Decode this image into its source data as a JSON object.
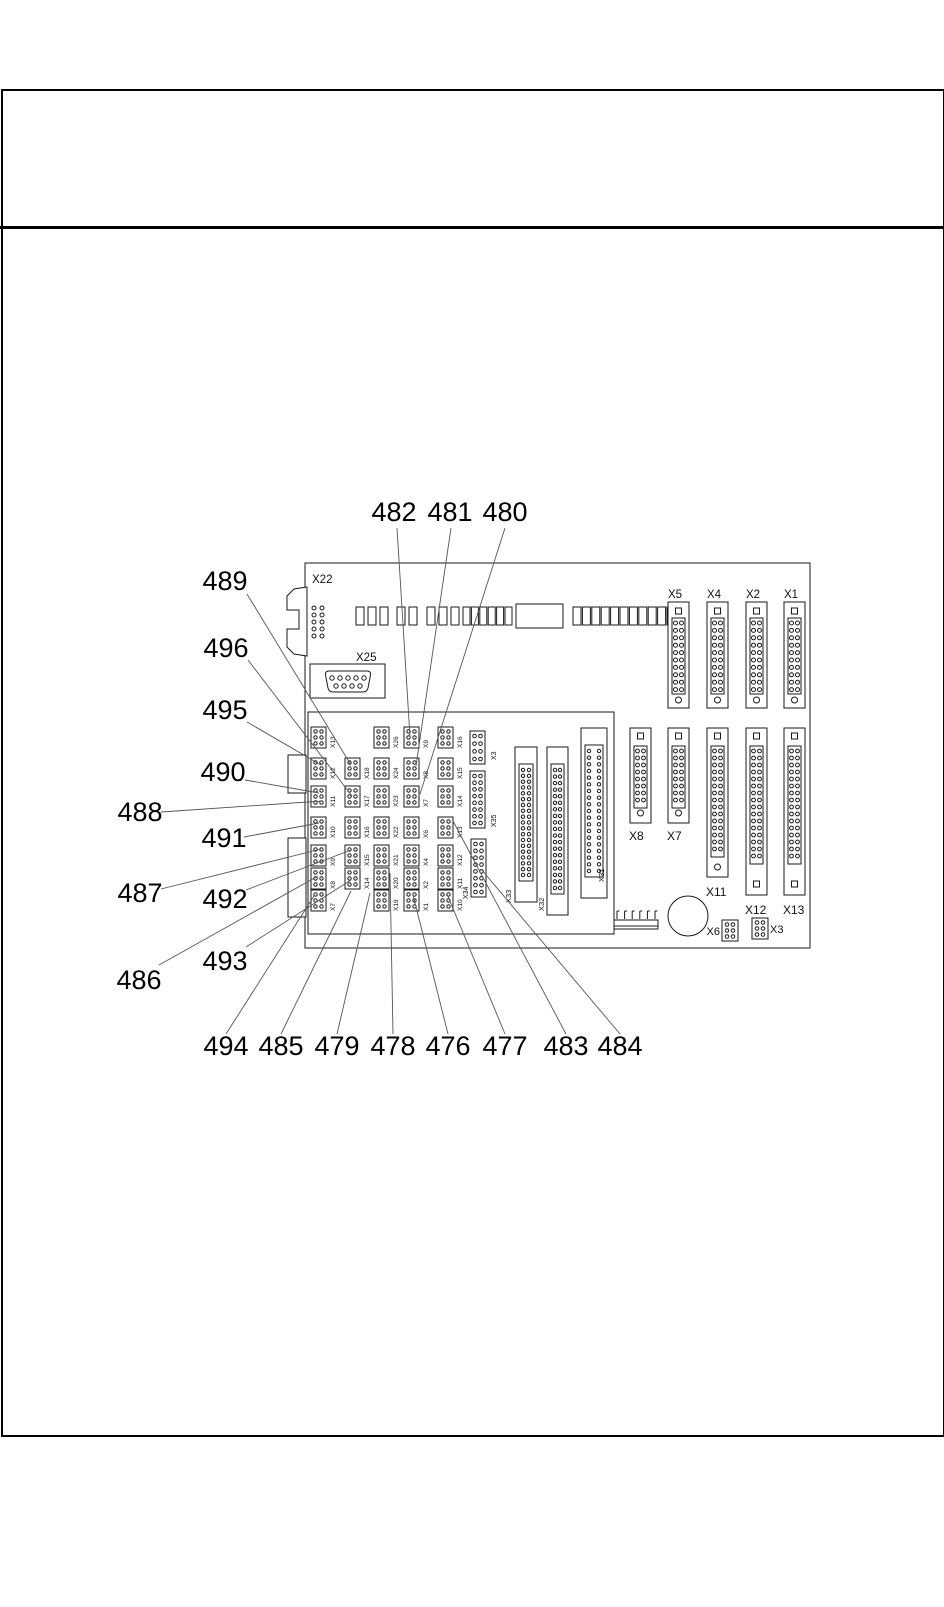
{
  "page": {
    "kind": "service-manual connector location diagram",
    "background": "#ffffff",
    "line_color": "#1a1a1a",
    "leader_color": "#555555"
  },
  "callouts": {
    "top": [
      {
        "label": "482",
        "x": 394,
        "y": 521,
        "line": [
          397,
          528,
          410,
          737
        ]
      },
      {
        "label": "481",
        "x": 450,
        "y": 521,
        "line": [
          451,
          528,
          416,
          766
        ]
      },
      {
        "label": "480",
        "x": 505,
        "y": 521,
        "line": [
          505,
          528,
          420,
          794
        ]
      }
    ],
    "left": [
      {
        "label": "489",
        "x": 225,
        "y": 590,
        "line": [
          247,
          594,
          351,
          765
        ]
      },
      {
        "label": "496",
        "x": 226,
        "y": 657,
        "line": [
          248,
          660,
          352,
          796
        ]
      },
      {
        "label": "495",
        "x": 225,
        "y": 719,
        "line": [
          247,
          722,
          321,
          765
        ]
      },
      {
        "label": "490",
        "x": 223,
        "y": 781,
        "line": [
          245,
          780,
          319,
          793
        ]
      },
      {
        "label": "488",
        "x": 140,
        "y": 821,
        "line": [
          161,
          812,
          322,
          801
        ]
      },
      {
        "label": "491",
        "x": 224,
        "y": 847,
        "line": [
          244,
          837,
          319,
          823
        ]
      },
      {
        "label": "487",
        "x": 140,
        "y": 902,
        "line": [
          161,
          889,
          321,
          849
        ]
      },
      {
        "label": "492",
        "x": 225,
        "y": 908,
        "line": [
          246,
          890,
          351,
          850
        ]
      },
      {
        "label": "486",
        "x": 139,
        "y": 989,
        "line": [
          159,
          965,
          318,
          876
        ]
      },
      {
        "label": "493",
        "x": 225,
        "y": 970,
        "line": [
          246,
          947,
          351,
          880
        ]
      }
    ],
    "bottom": [
      {
        "label": "494",
        "x": 226,
        "y": 1055,
        "line": [
          226,
          1034,
          314,
          896
        ]
      },
      {
        "label": "485",
        "x": 281,
        "y": 1055,
        "line": [
          281,
          1034,
          351,
          891
        ]
      },
      {
        "label": "479",
        "x": 337,
        "y": 1055,
        "line": [
          337,
          1034,
          370,
          893
        ]
      },
      {
        "label": "478",
        "x": 393,
        "y": 1055,
        "line": [
          393,
          1034,
          390,
          873
        ]
      },
      {
        "label": "476",
        "x": 448,
        "y": 1055,
        "line": [
          448,
          1034,
          413,
          895
        ]
      },
      {
        "label": "477",
        "x": 505,
        "y": 1055,
        "line": [
          505,
          1034,
          447,
          894
        ]
      },
      {
        "label": "483",
        "x": 566,
        "y": 1055,
        "line": [
          566,
          1034,
          453,
          821
        ]
      },
      {
        "label": "484",
        "x": 620,
        "y": 1055,
        "line": [
          620,
          1034,
          481,
          869
        ]
      }
    ]
  },
  "board": {
    "bracket_connector": {
      "label": "X22"
    },
    "serial_connector": {
      "label": "X25"
    },
    "top_right_connectors": [
      {
        "label": "X5",
        "x": 668
      },
      {
        "label": "X4",
        "x": 707
      },
      {
        "label": "X2",
        "x": 746
      },
      {
        "label": "X1",
        "x": 784
      }
    ],
    "right_connectors": [
      {
        "label": "X8",
        "x": 630,
        "h": 95,
        "rows": 8,
        "label_y": 840,
        "bottom": "circle"
      },
      {
        "label": "X7",
        "x": 668,
        "h": 95,
        "rows": 8,
        "label_y": 840,
        "bottom": "circle"
      },
      {
        "label": "X11",
        "x": 707,
        "h": 149,
        "rows": 15,
        "label_y": 896,
        "bottom": "circle"
      },
      {
        "label": "X12",
        "x": 746,
        "h": 167,
        "rows": 16,
        "label_y": 914,
        "bottom": "square"
      },
      {
        "label": "X13",
        "x": 784,
        "h": 167,
        "rows": 16,
        "label_y": 914,
        "bottom": "square"
      }
    ],
    "center_connectors": [
      {
        "label": "X33",
        "x": 515,
        "y": 747,
        "w": 22,
        "h": 155,
        "lab": [
          511,
          903
        ]
      },
      {
        "label": "X32",
        "x": 547,
        "y": 747,
        "w": 21,
        "h": 168,
        "lab": [
          544,
          911
        ]
      },
      {
        "label": "X31",
        "x": 581,
        "y": 728,
        "w": 26,
        "h": 170,
        "lab": [
          604,
          882
        ]
      }
    ],
    "pin_strips": [
      {
        "label": "X3",
        "x": 470,
        "y": 731,
        "h": 33,
        "rows": 4,
        "lab": [
          496,
          760
        ]
      },
      {
        "label": "X35",
        "x": 470,
        "y": 771,
        "h": 57,
        "rows": 8,
        "lab": [
          496,
          827
        ]
      },
      {
        "label": "X34",
        "x": 471,
        "y": 839,
        "h": 58,
        "rows": 8,
        "lab": [
          468,
          899
        ]
      }
    ],
    "jumper_grid": {
      "col_x": [
        311,
        345,
        374,
        404,
        438
      ],
      "row_y": [
        727,
        758,
        786,
        817,
        845,
        868,
        890
      ],
      "labels": [
        [
          "X13",
          "X12",
          "X11",
          "X10",
          "X9",
          "X8",
          "X7"
        ],
        [
          null,
          "X18",
          "X17",
          "X16",
          "X15",
          "X14",
          null
        ],
        [
          "X26",
          "X24",
          "X23",
          "X22",
          "X21",
          "X20",
          "X19"
        ],
        [
          "X9",
          "X8",
          "X7",
          "X6",
          "X4",
          "X2",
          "X1"
        ],
        [
          "X16",
          "X15",
          "X14",
          "X13",
          "X12",
          "X11",
          "X10"
        ]
      ]
    },
    "bottom_jumpers": [
      {
        "label": "X6",
        "x": 722,
        "y": 920,
        "label_side": "left"
      },
      {
        "label": "X3",
        "x": 752,
        "y": 918,
        "label_side": "right"
      }
    ]
  }
}
